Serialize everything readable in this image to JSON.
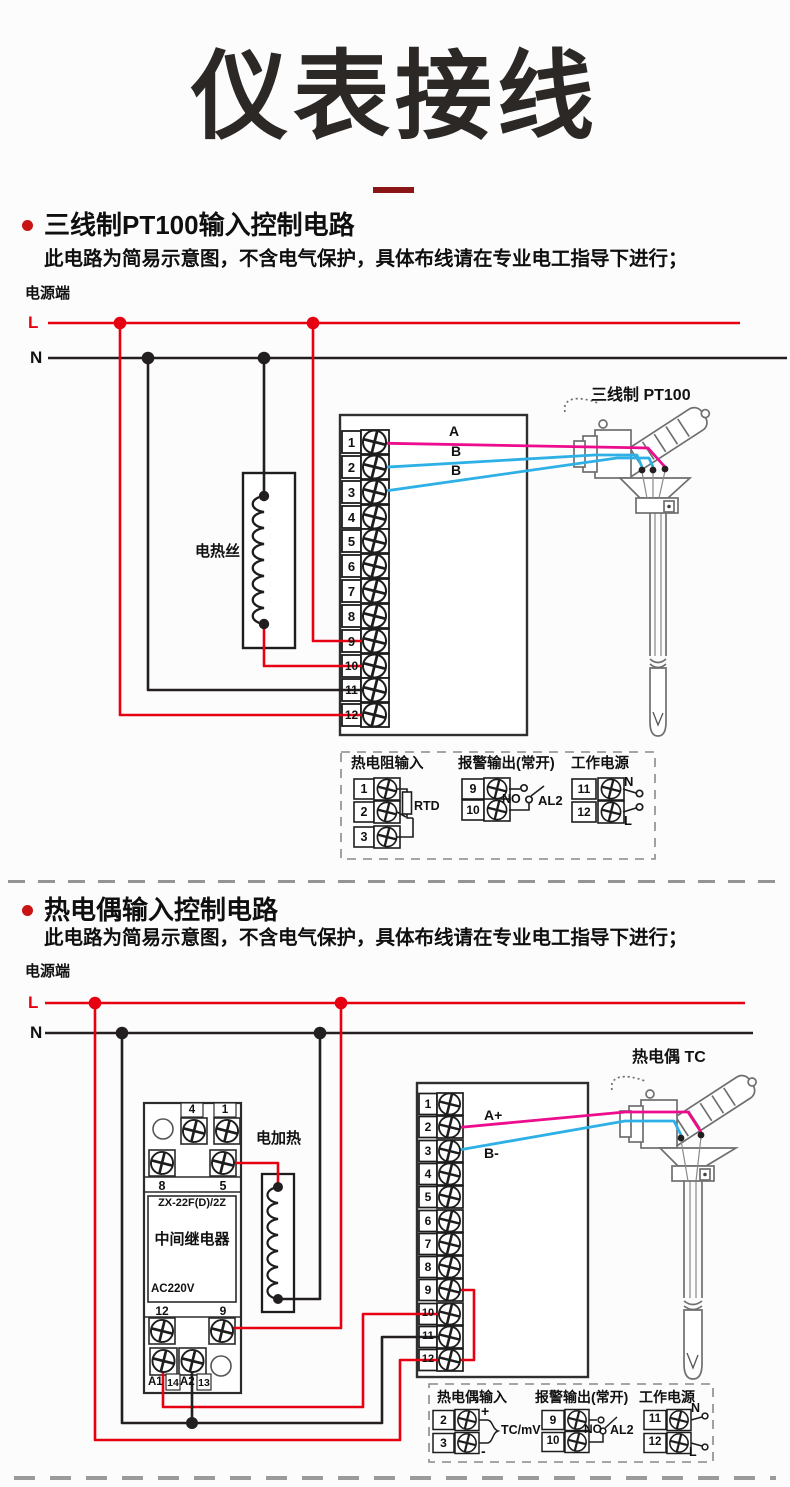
{
  "page": {
    "title": "仪表接线"
  },
  "colors": {
    "wire_red": "#e60012",
    "wire_black": "#231f20",
    "wire_magenta": "#ec0c8d",
    "wire_cyan": "#2eb0e6",
    "title_dash": "#8c1515",
    "bullet_red": "#c81414"
  },
  "section1": {
    "heading": "三线制PT100输入控制电路",
    "note": "此电路为简易示意图，不含电气保护，具体布线请在专业电工指导下进行；",
    "power_label": "电源端",
    "line_l": "L",
    "line_n": "N",
    "heater_label": "电热丝",
    "sensor_label": "三线制 PT100",
    "wire_labels": {
      "a": "A",
      "b1": "B",
      "b2": "B"
    },
    "terminals": [
      "1",
      "2",
      "3",
      "4",
      "5",
      "6",
      "7",
      "8",
      "9",
      "10",
      "11",
      "12"
    ],
    "legend": {
      "rtd": {
        "title": "热电阻输入",
        "t1": "1",
        "t2": "2",
        "t3": "3",
        "component": "RTD"
      },
      "alarm": {
        "title": "报警输出(常开)",
        "t1": "9",
        "t2": "10",
        "no": "NO",
        "name": "AL2"
      },
      "power": {
        "title": "工作电源",
        "t1": "11",
        "t2": "12",
        "n": "N",
        "l": "L"
      }
    }
  },
  "section2": {
    "heading": "热电偶输入控制电路",
    "note": "此电路为简易示意图，不含电气保护，具体布线请在专业电工指导下进行；",
    "power_label": "电源端",
    "line_l": "L",
    "line_n": "N",
    "heater_label": "电加热",
    "sensor_label": "热电偶 TC",
    "relay": {
      "t4": "4",
      "t1": "1",
      "t8": "8",
      "t5": "5",
      "model": "ZX-22F(D)/2Z",
      "name": "中间继电器",
      "voltage": "AC220V",
      "t12": "12",
      "t9": "9",
      "a1": "A1",
      "n14": "14",
      "a2": "A2",
      "n13": "13"
    },
    "wire_labels": {
      "a": "A+",
      "b": "B-"
    },
    "terminals": [
      "1",
      "2",
      "3",
      "4",
      "5",
      "6",
      "7",
      "8",
      "9",
      "10",
      "11",
      "12"
    ],
    "legend": {
      "tc": {
        "title": "热电偶输入",
        "t1": "2",
        "t2": "3",
        "plus": "+",
        "minus": "-",
        "component": "TC/mV"
      },
      "alarm": {
        "title": "报警输出(常开)",
        "t1": "9",
        "t2": "10",
        "no": "NO",
        "name": "AL2"
      },
      "power": {
        "title": "工作电源",
        "t1": "11",
        "t2": "12",
        "n": "N",
        "l": "L"
      }
    }
  }
}
